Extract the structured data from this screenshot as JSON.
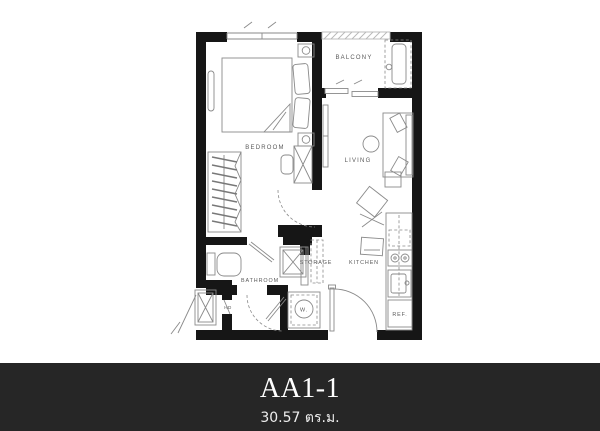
{
  "footer": {
    "title": "AA1-1",
    "subtitle": "30.57 ตร.ม."
  },
  "plan": {
    "labels": {
      "bedroom": "BEDROOM",
      "balcony": "BALCONY",
      "living": "LIVING",
      "bathroom": "BATHROOM",
      "storage": "STORAGE",
      "kitchen": "KITCHEN",
      "washer": "W.",
      "refrigerator": "REF.",
      "water_heater": "HD"
    },
    "colors": {
      "wall": "#161616",
      "line": "#8a8a8a",
      "label": "#5a5a5a",
      "rail": "#b8b8b8",
      "footer_bg": "#262626",
      "footer_text": "#ffffff",
      "page_bg": "#ffffff"
    }
  }
}
